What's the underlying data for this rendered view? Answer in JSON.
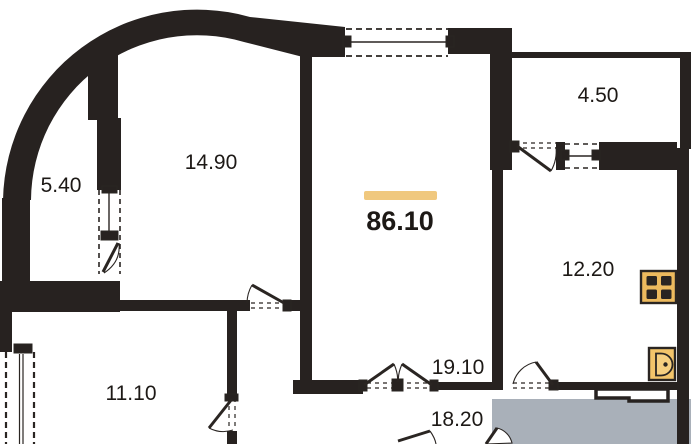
{
  "plan": {
    "total_area": "86.10",
    "room_areas": {
      "balcony": "5.40",
      "room_top": "14.90",
      "bathroom": "4.50",
      "kitchen": "12.20",
      "living": "19.10",
      "room_left": "11.10",
      "room_bottom": "18.20"
    },
    "icons": {
      "stove": "stove-icon",
      "sink": "sink-icon"
    },
    "colors": {
      "wall": "#272220",
      "accent_bar": "#f0c87e",
      "stove_fill": "#edba5e",
      "sink_fill": "#f3c46a",
      "overlay_gray": "#a9b0b9"
    }
  }
}
